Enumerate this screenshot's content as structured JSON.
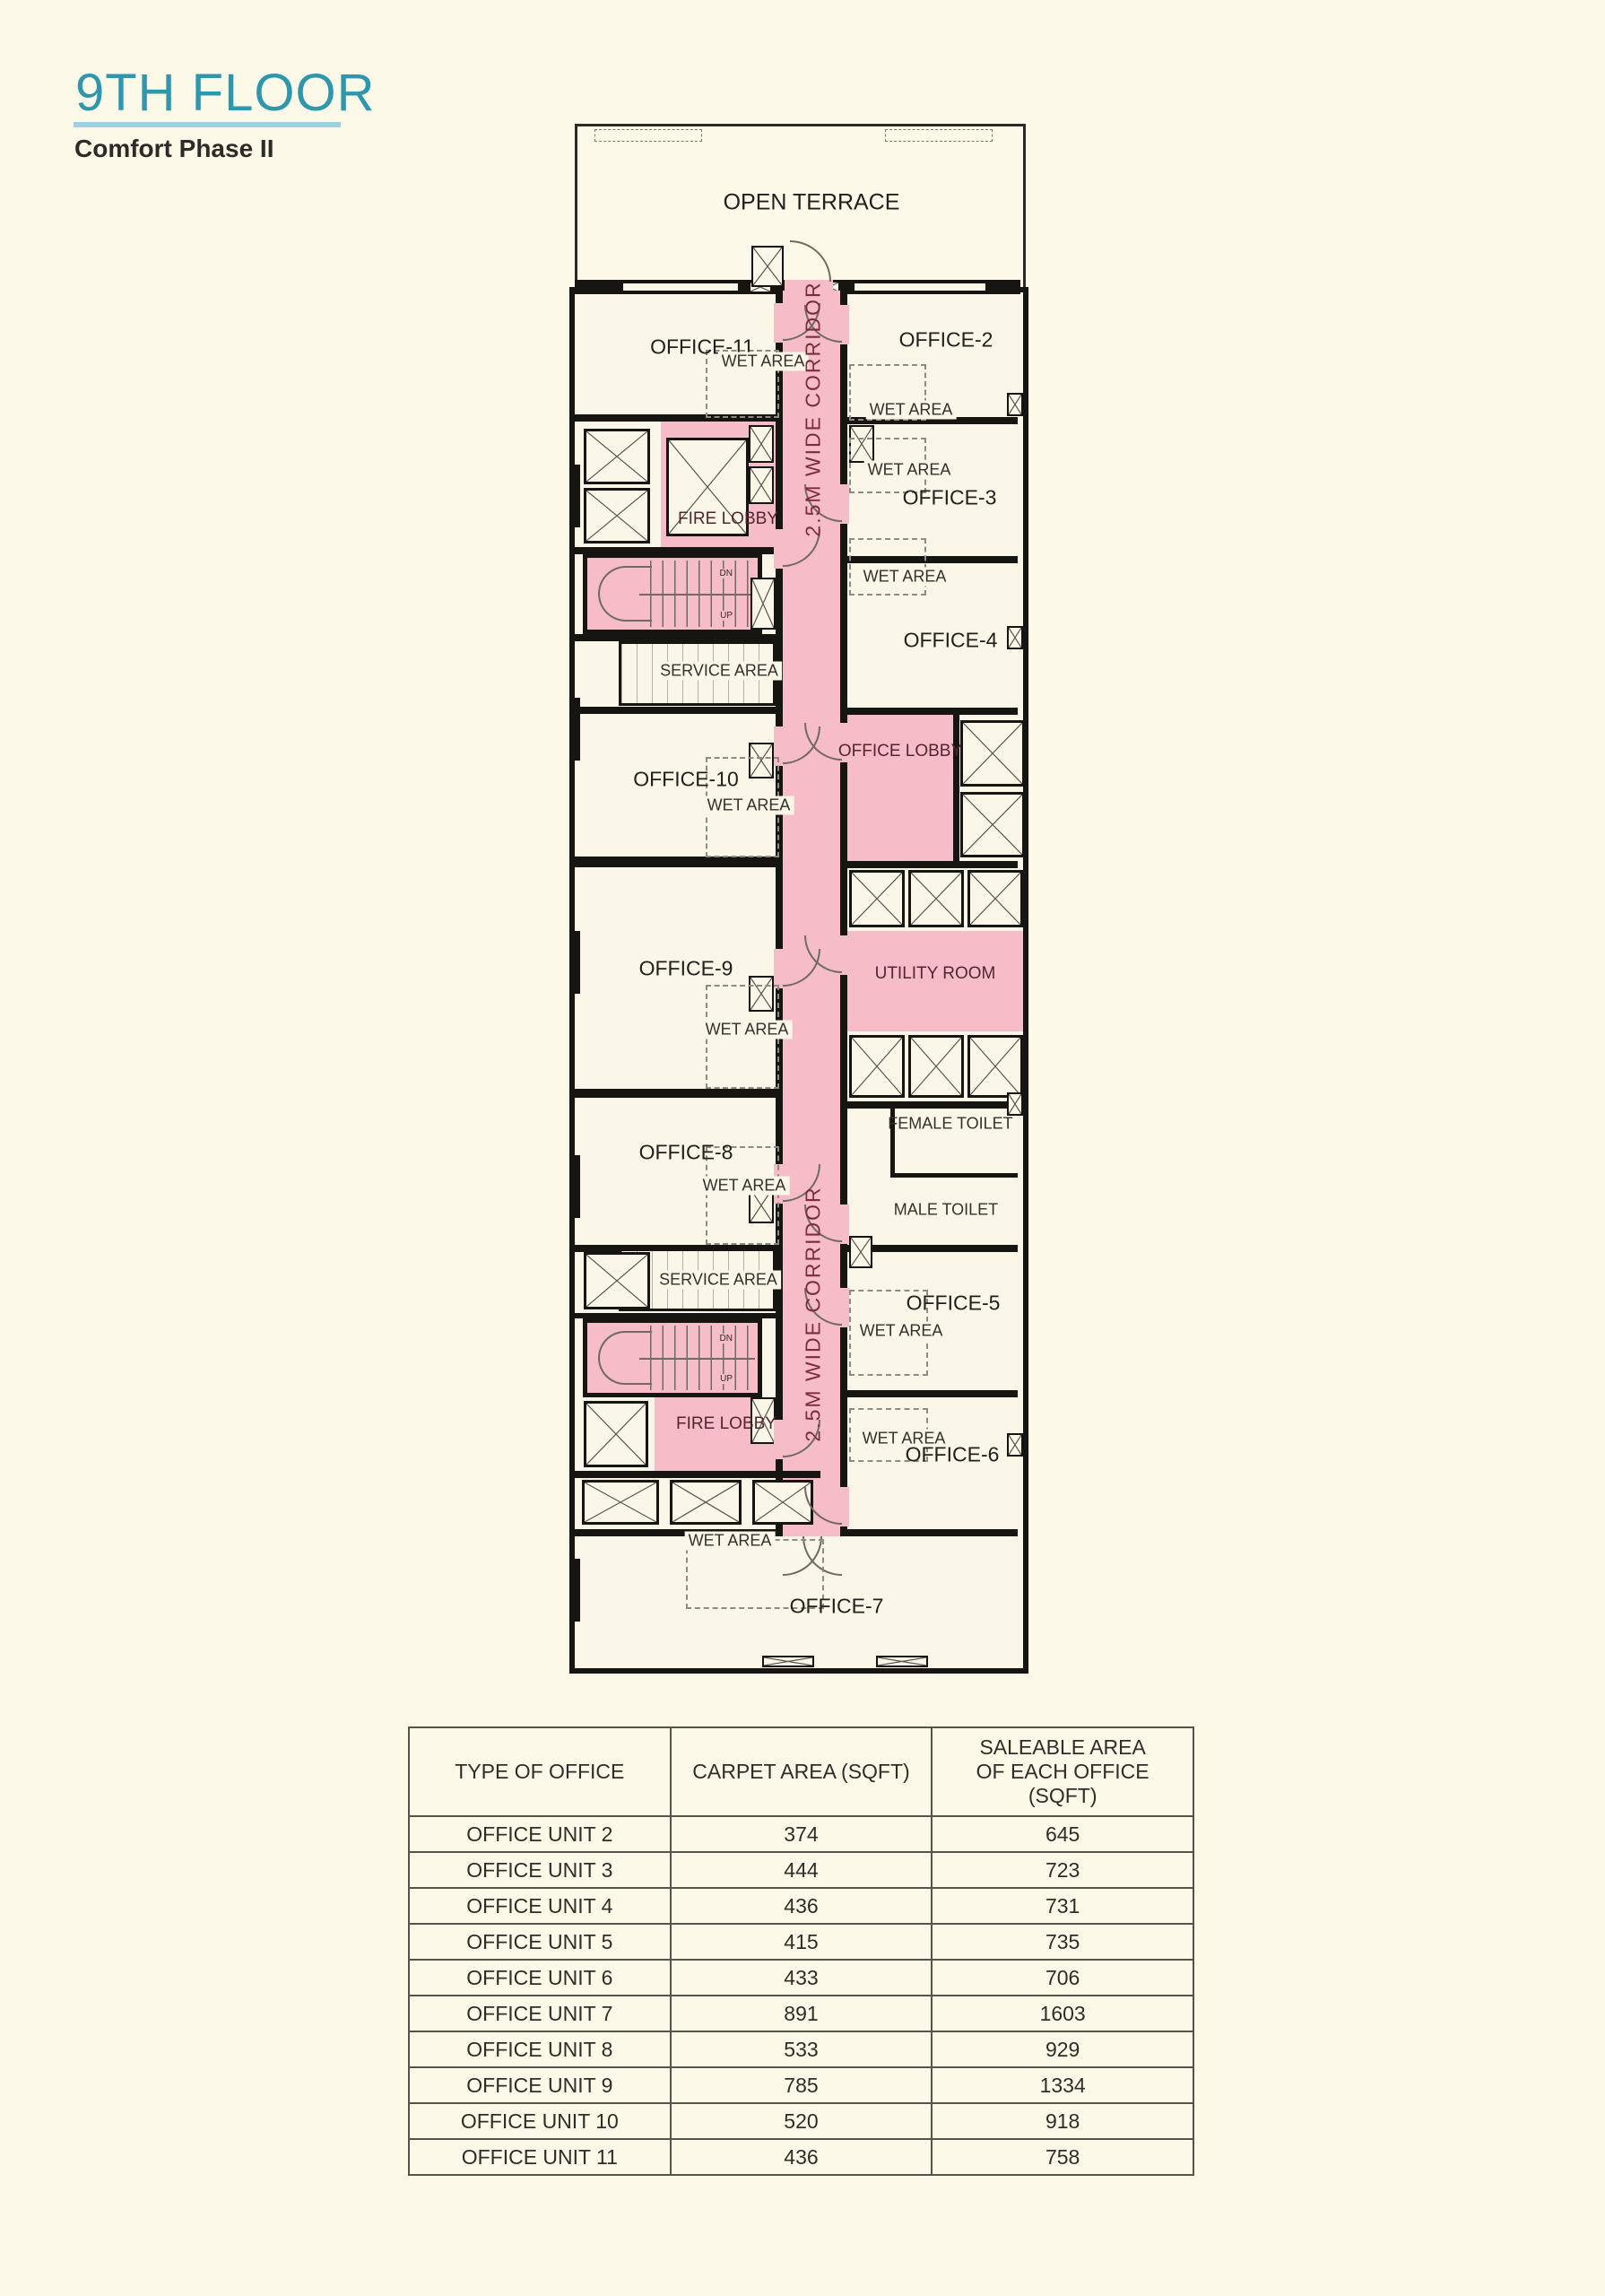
{
  "header": {
    "title": "9TH FLOOR",
    "subtitle": "Comfort Phase II"
  },
  "colors": {
    "background": "#fdf9e8",
    "corridor_pink": "#f6bcc8",
    "wall": "#171512",
    "accent_teal": "#2f97ad",
    "underline_blue": "#9ed0df",
    "corridor_text": "#7c2c3c"
  },
  "plan": {
    "labels": {
      "open_terrace": "OPEN TERRACE",
      "office_2": "OFFICE-2",
      "office_3": "OFFICE-3",
      "office_4": "OFFICE-4",
      "office_5": "OFFICE-5",
      "office_6": "OFFICE-6",
      "office_7": "OFFICE-7",
      "office_8": "OFFICE-8",
      "office_9": "OFFICE-9",
      "office_10": "OFFICE-10",
      "office_11": "OFFICE-11",
      "wet_area": "WET AREA",
      "fire_lobby": "FIRE LOBBY",
      "service_area": "SERVICE AREA",
      "office_lobby": "OFFICE LOBBY",
      "utility_room": "UTILITY ROOM",
      "female_toilet": "FEMALE TOILET",
      "male_toilet": "MALE TOILET",
      "corridor": "2.5M WIDE CORRIDOR",
      "dn": "DN",
      "up": "UP"
    }
  },
  "table": {
    "headers": [
      "TYPE OF OFFICE",
      "CARPET AREA (SQFT)",
      "SALEABLE AREA\nOF EACH OFFICE\n(SQFT)"
    ],
    "rows": [
      {
        "type": "OFFICE UNIT 2",
        "carpet": "374",
        "saleable": "645"
      },
      {
        "type": "OFFICE UNIT 3",
        "carpet": "444",
        "saleable": "723"
      },
      {
        "type": "OFFICE UNIT 4",
        "carpet": "436",
        "saleable": "731"
      },
      {
        "type": "OFFICE UNIT 5",
        "carpet": "415",
        "saleable": "735"
      },
      {
        "type": "OFFICE UNIT 6",
        "carpet": "433",
        "saleable": "706"
      },
      {
        "type": "OFFICE UNIT 7",
        "carpet": "891",
        "saleable": "1603"
      },
      {
        "type": "OFFICE UNIT 8",
        "carpet": "533",
        "saleable": "929"
      },
      {
        "type": "OFFICE UNIT 9",
        "carpet": "785",
        "saleable": "1334"
      },
      {
        "type": "OFFICE UNIT 10",
        "carpet": "520",
        "saleable": "918"
      },
      {
        "type": "OFFICE UNIT 11",
        "carpet": "436",
        "saleable": "758"
      }
    ]
  }
}
